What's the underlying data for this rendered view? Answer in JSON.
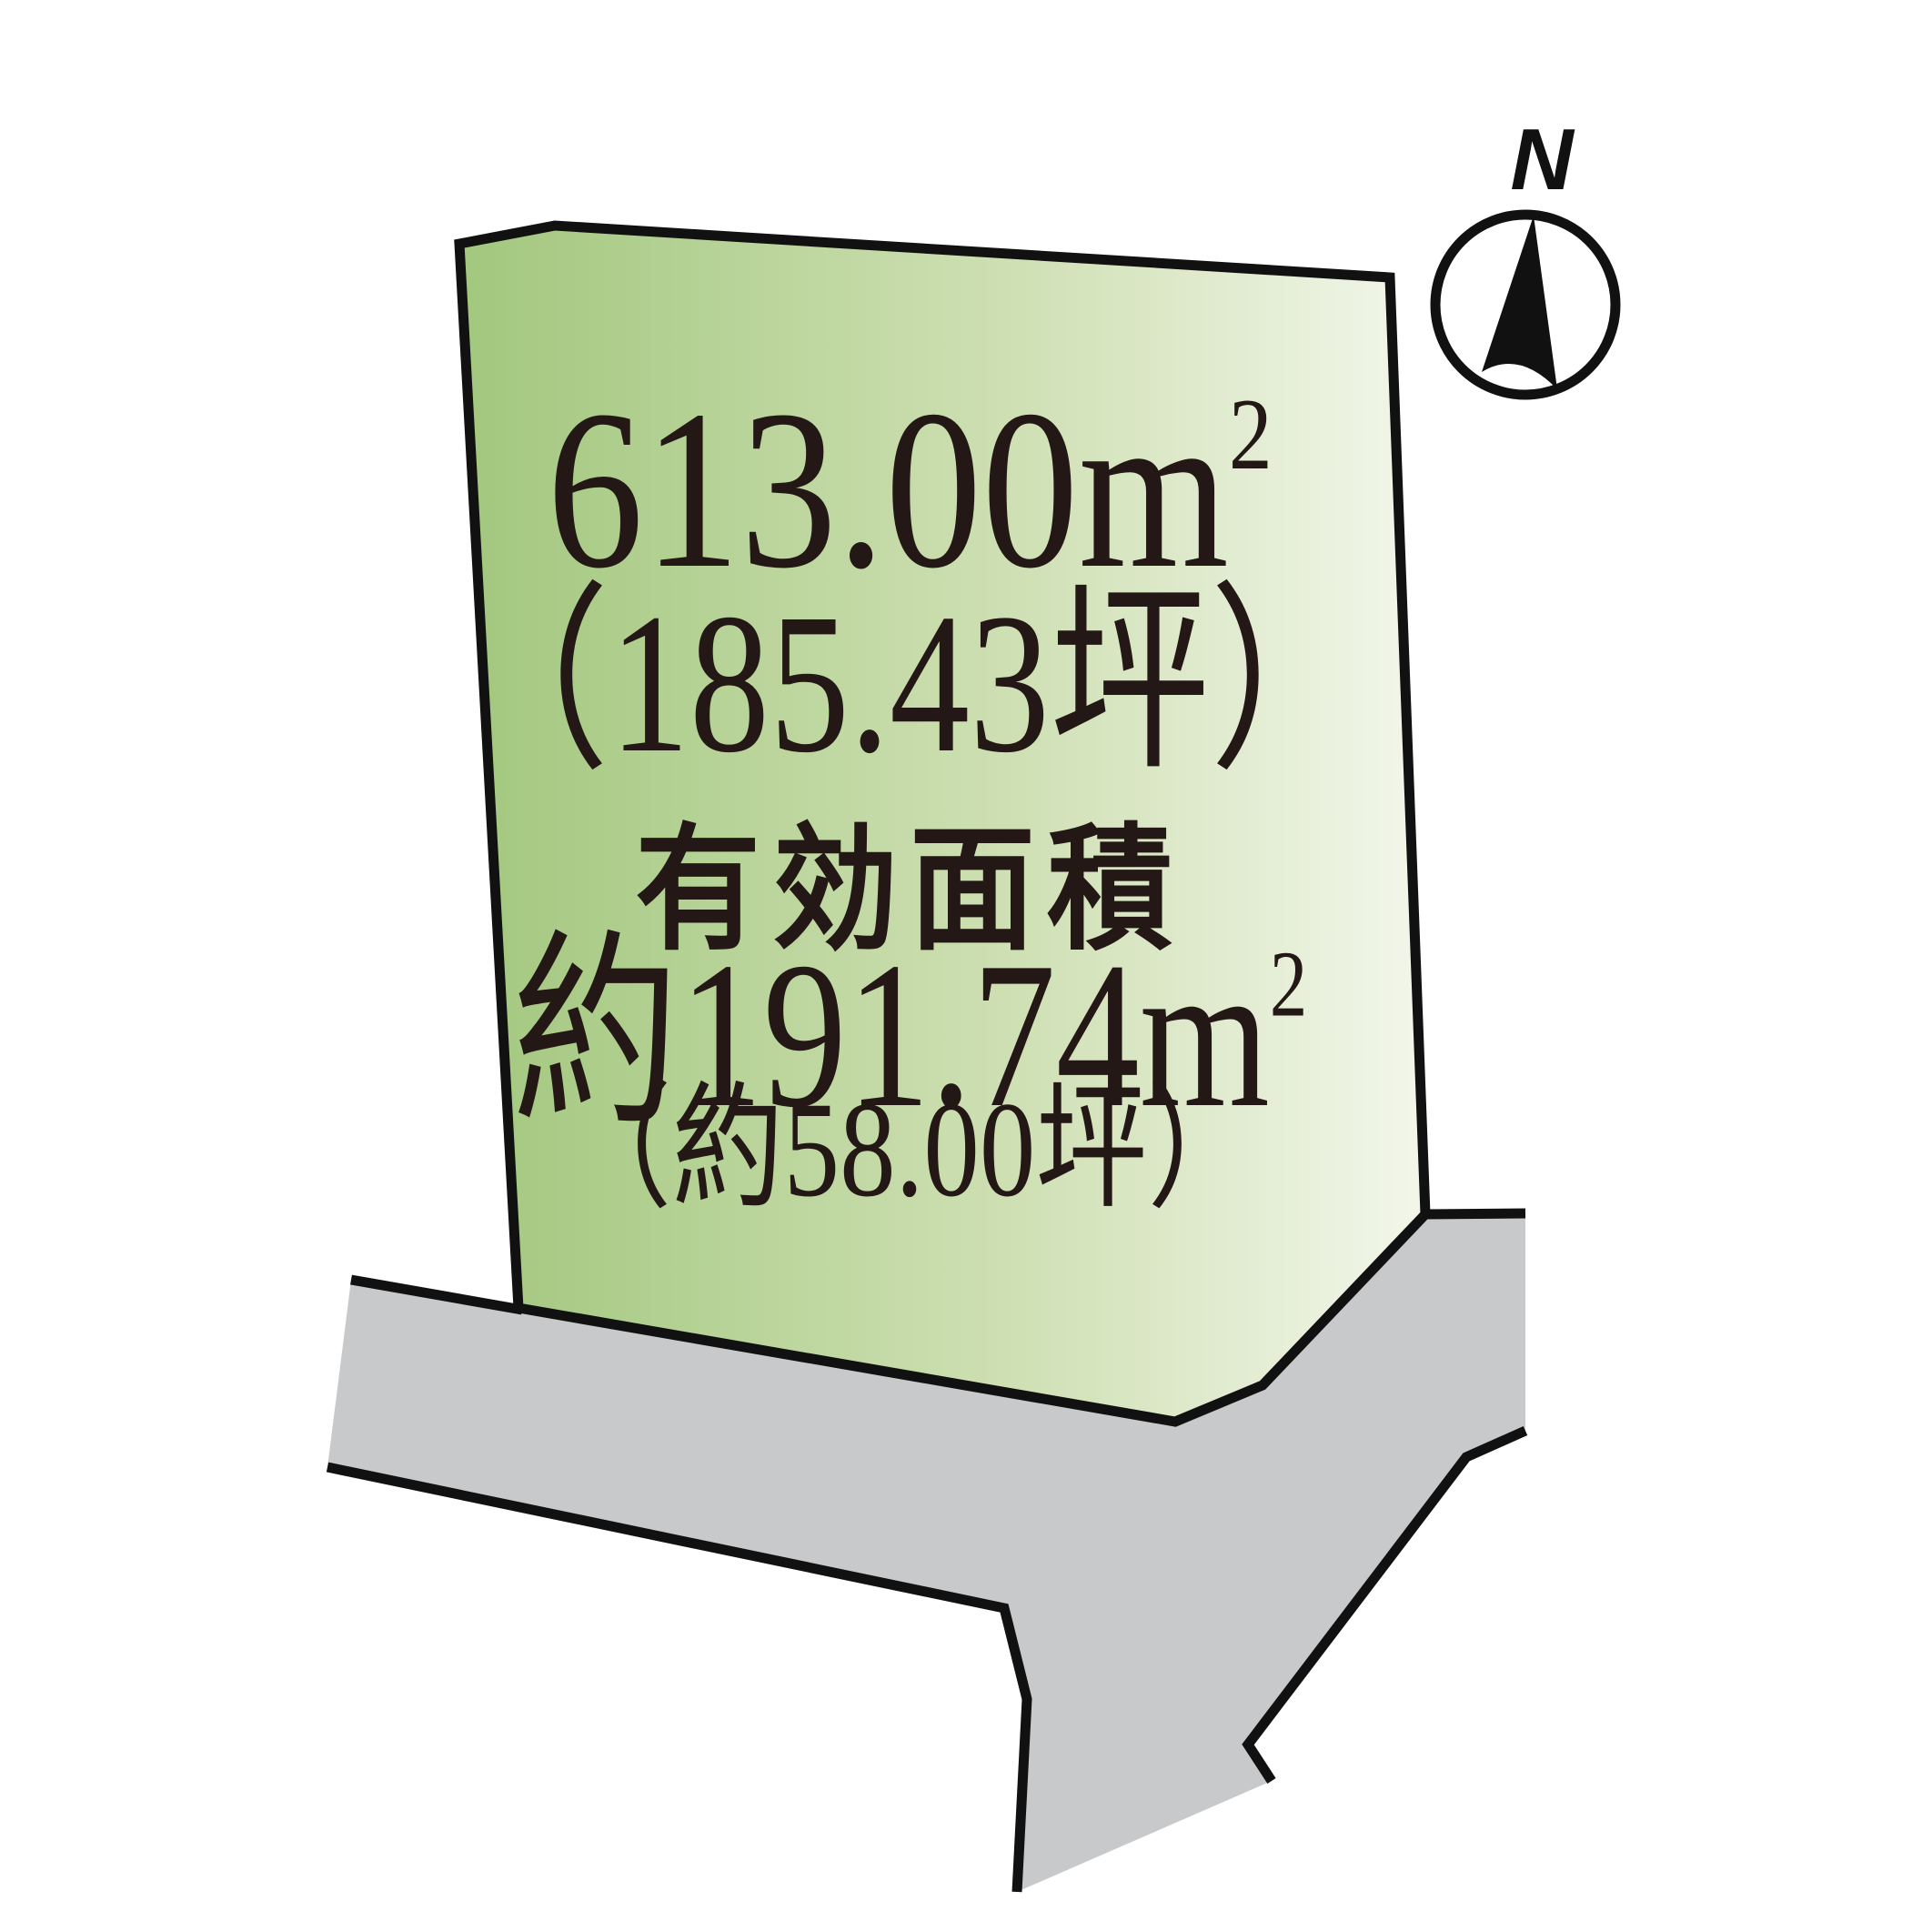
{
  "compass": {
    "north_label": "N"
  },
  "parcel": {
    "area_sqm_base": "613.00m",
    "area_sqm_sup": "2",
    "area_tsubo": "（185.43坪）",
    "effective_area_label": "有効面積",
    "effective_sqm_base": "約191.74m",
    "effective_sqm_sup": "2",
    "effective_tsubo": "（約58.00坪）"
  },
  "colors": {
    "parcel_gradient_start": "#a2c77e",
    "parcel_gradient_mid": "#cfe0b4",
    "parcel_gradient_end": "#f7f9f1",
    "road_fill": "#c8c9ca",
    "outline": "#111111",
    "text": "#231815",
    "background": "#ffffff"
  }
}
